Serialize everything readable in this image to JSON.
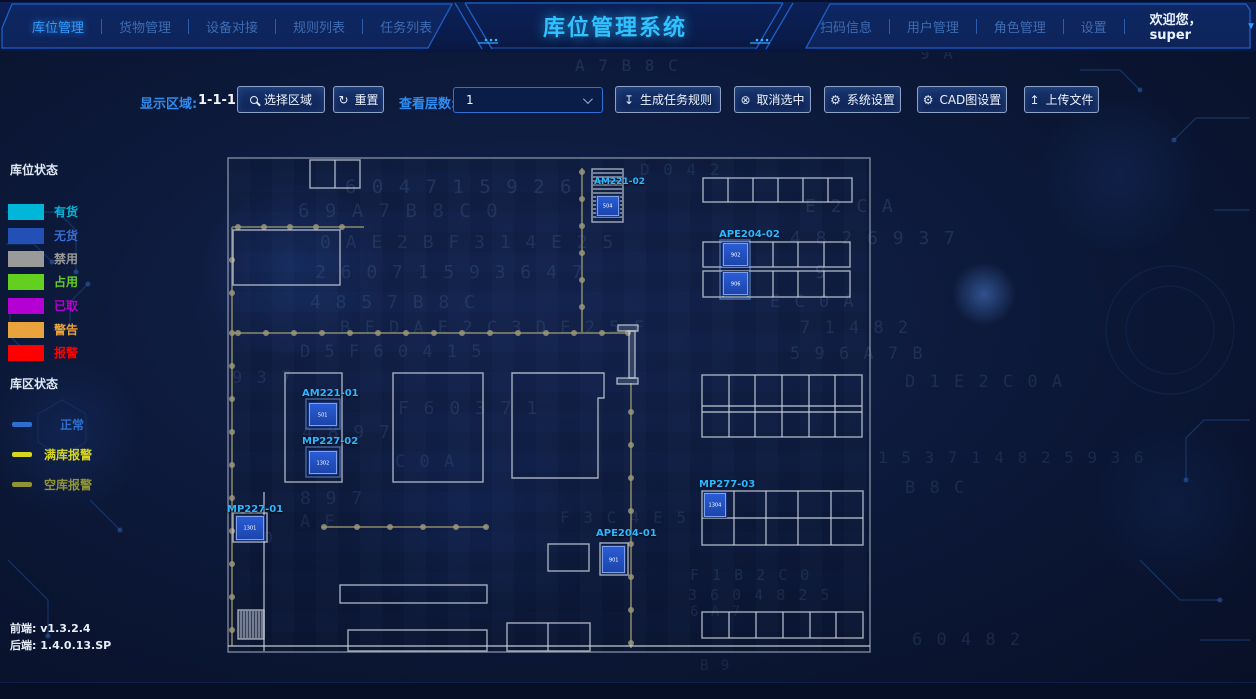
{
  "header": {
    "brand_title": "库位管理系统",
    "left_nav": [
      {
        "label": "库位管理",
        "active": true
      },
      {
        "label": "货物管理",
        "active": false
      },
      {
        "label": "设备对接",
        "active": false
      },
      {
        "label": "规则列表",
        "active": false
      },
      {
        "label": "任务列表",
        "active": false
      }
    ],
    "right_nav": [
      {
        "label": "扫码信息"
      },
      {
        "label": "用户管理"
      },
      {
        "label": "角色管理"
      },
      {
        "label": "设置"
      }
    ],
    "welcome": "欢迎您，super",
    "caret_icon": "▼"
  },
  "toolbar": {
    "display_area_label": "显示区域:",
    "display_area_value": "1-1-1",
    "select_region_btn": "选择区域",
    "reset_btn": "重置",
    "layer_label": "查看层数:",
    "layer_value": "1",
    "generate_btn": "生成任务规则",
    "cancel_btn": "取消选中",
    "system_btn": "系统设置",
    "cad_btn": "CAD图设置",
    "upload_btn": "上传文件",
    "icons": {
      "reset": "↻",
      "generate": "↧",
      "cancel": "⊗",
      "gear": "⚙",
      "upload": "↥"
    }
  },
  "legend": {
    "slot_title": "库位状态",
    "slot_items": [
      {
        "label": "有货",
        "color": "#00b6d9"
      },
      {
        "label": "无货",
        "color": "#2350b4"
      },
      {
        "label": "禁用",
        "color": "#9a9a9a"
      },
      {
        "label": "占用",
        "color": "#63cf1e"
      },
      {
        "label": "已取",
        "color": "#b400d2"
      },
      {
        "label": "警告",
        "color": "#e8a33c"
      },
      {
        "label": "报警",
        "color": "#ff0000"
      }
    ],
    "zone_title": "库区状态",
    "zone_items": [
      {
        "label": "正常",
        "color": "#2e6fd0"
      },
      {
        "label": "满库报警",
        "color": "#d6d621"
      },
      {
        "label": "空库报警",
        "color": "#8f9434"
      }
    ]
  },
  "versions": {
    "frontend_label": "前端:",
    "frontend_value": "v1.3.2.4",
    "backend_label": "后端:",
    "backend_value": "1.4.0.13.SP"
  },
  "floorplan": {
    "units": [
      {
        "id": "AM221-02",
        "cells": [
          "504"
        ]
      },
      {
        "id": "APE204-02",
        "cells": [
          "902",
          "906"
        ]
      },
      {
        "id": "AM221-01",
        "cells": [
          "501"
        ]
      },
      {
        "id": "MP227-02",
        "cells": [
          "1302"
        ]
      },
      {
        "id": "MP227-01",
        "cells": [
          "1301"
        ]
      },
      {
        "id": "MP277-03",
        "cells": [
          "1304"
        ]
      },
      {
        "id": "APE204-01",
        "cells": [
          "901"
        ]
      }
    ]
  },
  "background_glyphs": [
    {
      "t": "0 3",
      "x": 552,
      "y": 32,
      "s": 16,
      "o": 0.13
    },
    {
      "t": "9 A",
      "x": 920,
      "y": 44,
      "s": 16,
      "o": 0.14
    },
    {
      "t": "A 7   B 8   C",
      "x": 575,
      "y": 56,
      "s": 16,
      "o": 0.16
    },
    {
      "t": "D 0 4   2",
      "x": 640,
      "y": 160,
      "s": 16,
      "o": 0.13
    },
    {
      "t": "6 0 4 7 1   5 9 2 6",
      "x": 345,
      "y": 176,
      "s": 19,
      "o": 0.16
    },
    {
      "t": "6 9 A 7   B 8   C 0",
      "x": 298,
      "y": 200,
      "s": 19,
      "o": 0.15
    },
    {
      "t": "E 2 C   A",
      "x": 805,
      "y": 196,
      "s": 18,
      "o": 0.17
    },
    {
      "t": "0 A E 2 B F 3   1 4 E 2 5",
      "x": 320,
      "y": 232,
      "s": 18,
      "o": 0.15
    },
    {
      "t": "4 8 2 6 9 3 7",
      "x": 790,
      "y": 228,
      "s": 18,
      "o": 0.16
    },
    {
      "t": "2 6 0   7 1 5   9 3 6   4 7",
      "x": 315,
      "y": 262,
      "s": 18,
      "o": 0.15
    },
    {
      "t": "9",
      "x": 815,
      "y": 262,
      "s": 18,
      "o": 0.2
    },
    {
      "t": "4 8   5     7     B 8     C",
      "x": 310,
      "y": 292,
      "s": 18,
      "o": 0.14
    },
    {
      "t": "E   C 0 A",
      "x": 770,
      "y": 292,
      "s": 17,
      "o": 0.15
    },
    {
      "t": "B F   D   A E 2 C   3 D   E 2 5 F",
      "x": 340,
      "y": 318,
      "s": 17,
      "o": 0.15
    },
    {
      "t": "7 1 4 8 2",
      "x": 800,
      "y": 318,
      "s": 17,
      "o": 0.15
    },
    {
      "t": "D   5 F 6 0 4   1 5",
      "x": 300,
      "y": 342,
      "s": 17,
      "o": 0.14
    },
    {
      "t": "5 9   6   A 7   B",
      "x": 790,
      "y": 344,
      "s": 17,
      "o": 0.15
    },
    {
      "t": "9 3 7",
      "x": 232,
      "y": 368,
      "s": 17,
      "o": 0.13
    },
    {
      "t": "D 1   E 2 C 0 A",
      "x": 905,
      "y": 372,
      "s": 17,
      "o": 0.14
    },
    {
      "t": "F   6 0 3 7 1",
      "x": 398,
      "y": 398,
      "s": 18,
      "o": 0.14
    },
    {
      "t": "4 8     9   7",
      "x": 302,
      "y": 422,
      "s": 18,
      "o": 0.13
    },
    {
      "t": "1 5   3 7 1 4 8 2 5 9 3 6",
      "x": 878,
      "y": 448,
      "s": 16,
      "o": 0.13
    },
    {
      "t": "C 0 A",
      "x": 395,
      "y": 452,
      "s": 17,
      "o": 0.13
    },
    {
      "t": "8     9     7",
      "x": 300,
      "y": 488,
      "s": 18,
      "o": 0.13
    },
    {
      "t": "B 8   C",
      "x": 905,
      "y": 478,
      "s": 17,
      "o": 0.13
    },
    {
      "t": "A E",
      "x": 300,
      "y": 512,
      "s": 17,
      "o": 0.12
    },
    {
      "t": "3 D",
      "x": 240,
      "y": 528,
      "s": 16,
      "o": 0.12
    },
    {
      "t": "F 3 C 4 E   5",
      "x": 560,
      "y": 508,
      "s": 16,
      "o": 0.13
    },
    {
      "t": "F   1 B   2 C 0",
      "x": 690,
      "y": 566,
      "s": 15,
      "o": 0.14
    },
    {
      "t": "3 6 0 4 8 2 5",
      "x": 688,
      "y": 586,
      "s": 15,
      "o": 0.14
    },
    {
      "t": "6   A 7",
      "x": 690,
      "y": 604,
      "s": 14,
      "o": 0.12
    },
    {
      "t": "6 0 4 8 2",
      "x": 912,
      "y": 630,
      "s": 17,
      "o": 0.14
    },
    {
      "t": "B 9",
      "x": 700,
      "y": 658,
      "s": 14,
      "o": 0.12
    }
  ]
}
